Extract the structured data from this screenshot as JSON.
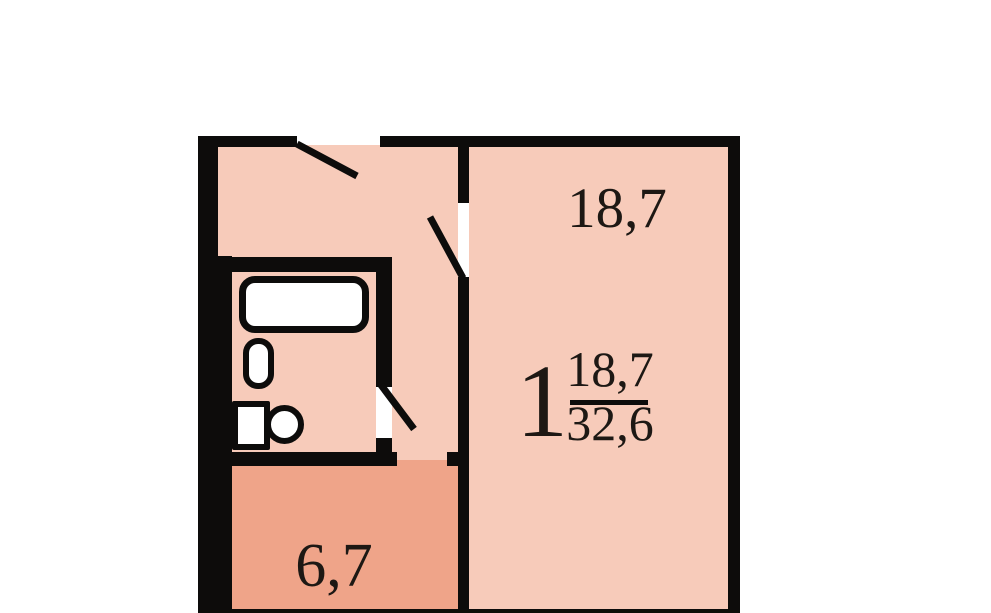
{
  "colors": {
    "background": "#ffffff",
    "wall": "#0d0c0b",
    "room_fill": "#f7cbba",
    "kitchen_fill": "#efa489",
    "fixture_fill": "#ffffff",
    "label_text": "#1d1814"
  },
  "living_room": {
    "area": "18,7"
  },
  "kitchen": {
    "area": "6,7"
  },
  "summary": {
    "rooms": "1",
    "living_area": "18,7",
    "total_area": "32,6"
  },
  "fixtures": {
    "bathtub": "bathtub-icon",
    "sink": "sink-icon",
    "toilet": "toilet-icon"
  }
}
